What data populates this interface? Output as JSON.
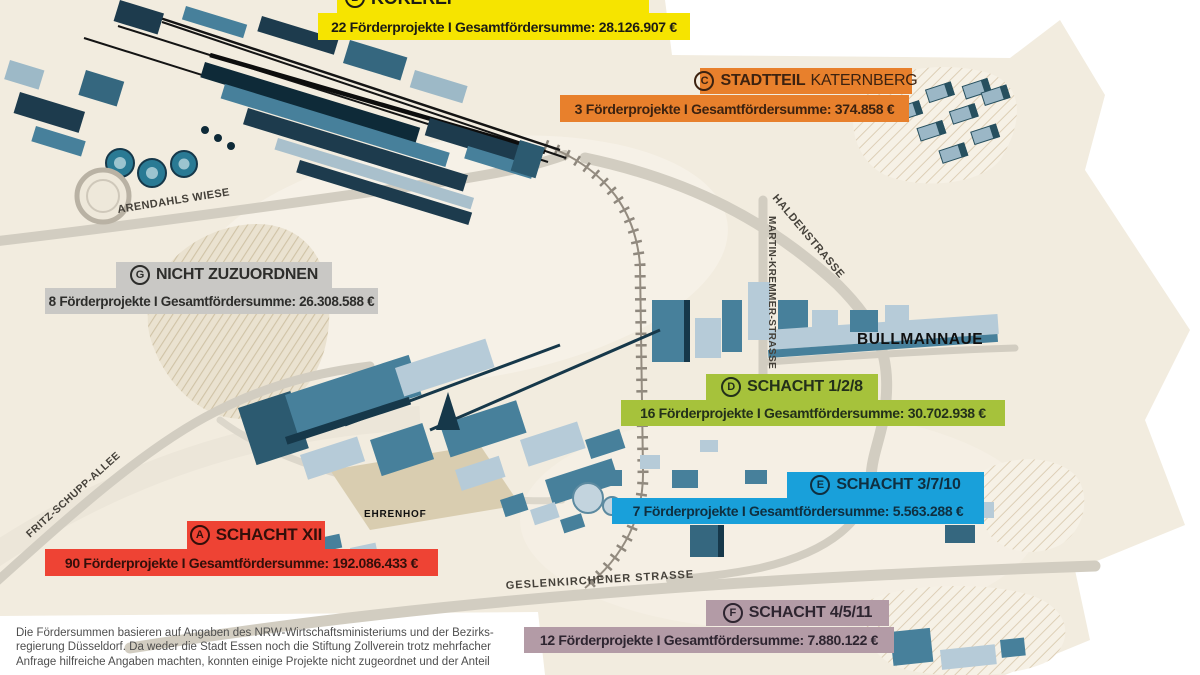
{
  "callouts": [
    {
      "id": "kokerei",
      "letter": "B",
      "name": "KOKEREI",
      "stats": "22 Förderprojekte  I  Gesamtfördersumme: 28.126.907 €",
      "color": "#f6e400",
      "text_color": "#1d1c14"
    },
    {
      "id": "katernberg",
      "letter": "C",
      "name": "STADTTEIL",
      "name_light": "KATERNBERG",
      "stats": "3 Förderprojekte  I  Gesamtfördersumme: 374.858 €",
      "color": "#e8802c",
      "text_color": "#3c2210"
    },
    {
      "id": "nicht-zuzuordnen",
      "letter": "G",
      "name": "NICHT ZUZUORDNEN",
      "stats": "8 Förderprojekte  I  Gesamtfördersumme: 26.308.588 €",
      "color": "#c9c8c5",
      "text_color": "#2d2d2b"
    },
    {
      "id": "schacht-1-2-8",
      "letter": "D",
      "name": "SCHACHT 1/2/8",
      "stats": "16 Förderprojekte  I  Gesamtfördersumme: 30.702.938 €",
      "color": "#a6c23b",
      "text_color": "#23301a"
    },
    {
      "id": "schacht-3-7-10",
      "letter": "E",
      "name": "SCHACHT 3/7/10",
      "stats": "7 Förderprojekte  I  Gesamtfördersumme: 5.563.288 €",
      "color": "#19a0da",
      "text_color": "#0f2f40"
    },
    {
      "id": "schacht-xii",
      "letter": "A",
      "name": "SCHACHT XII",
      "stats": "90 Förderprojekte  I  Gesamtfördersumme: 192.086.433 €",
      "color": "#ee4334",
      "text_color": "#330f0a"
    },
    {
      "id": "schacht-4-5-11",
      "letter": "F",
      "name": "SCHACHT 4/5/11",
      "stats": "12 Förderprojekte  I  Gesamtfördersumme: 7.880.122 €",
      "color": "#b39ba6",
      "text_color": "#2e2530"
    }
  ],
  "streets": {
    "arendahls": "ARENDAHLS WIESE",
    "haldenstrasse": "HALDENSTRASSE",
    "martin_kremmer": "MARTIN-KREMMER-STRASSE",
    "fritz_schupp": "FRITZ-SCHUPP-ALLEE",
    "gelsenkirchener": "GESLENKIRCHENER STRASSE"
  },
  "places": {
    "bullmannaue": "BULLMANNAUE",
    "ehrenhof": "EHRENHOF"
  },
  "footnote": {
    "lines": [
      "Die Fördersummen basieren auf Angaben des NRW-Wirtschaftsministeriums und der Bezirks-",
      "regierung Düsseldorf. Da weder die Stadt Essen noch die Stiftung Zollverein trotz mehrfacher",
      "Anfrage hilfreiche Angaben machten, konnten einige Projekte nicht zugeordnet und der Anteil"
    ]
  },
  "map_colors": {
    "paper": "#f2ecdf",
    "road": "#d2cdc1",
    "building_steel": "#47809b",
    "building_light": "#b6cbd8",
    "building_dark": "#1d3b4d"
  }
}
